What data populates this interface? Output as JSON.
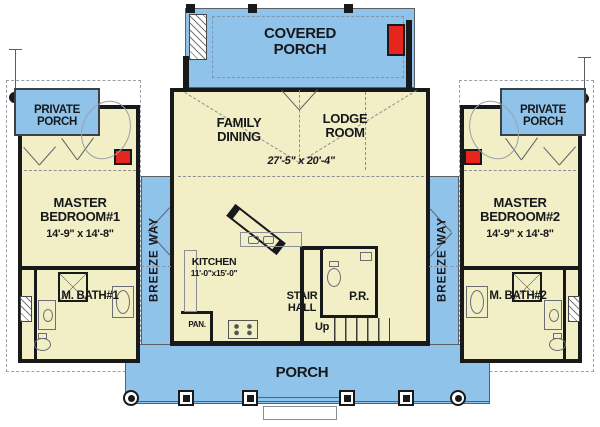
{
  "colors": {
    "porch_blue": "#8fc3ea",
    "room_cream": "#f2eec5",
    "wall_black": "#17191b",
    "fireplace_red": "#e6251c"
  },
  "rooms": {
    "covered_porch": {
      "label": "COVERED PORCH"
    },
    "great_room": {
      "dining_label": "FAMILY DINING",
      "lodge_label": "LODGE ROOM",
      "dims": "27'-5\" x 20'-4\""
    },
    "kitchen": {
      "label": "KITCHEN",
      "dims": "11'-0\"x15'-0\"",
      "pantry_label": "PAN."
    },
    "stair_hall": {
      "label": "STAIR HALL",
      "up_label": "Up",
      "powder_label": "P.R."
    },
    "porch": {
      "label": "PORCH"
    },
    "breezeways": {
      "left": "BREEZE WAY",
      "right": "BREEZE WAY"
    },
    "private_porches": {
      "left": "PRIVATE PORCH",
      "right": "PRIVATE PORCH"
    },
    "master_bedroom_1": {
      "label": "MASTER BEDROOM#1",
      "dims": "14'-9\" x 14'-8\""
    },
    "master_bedroom_2": {
      "label": "MASTER BEDROOM#2",
      "dims": "14'-9\" x 14'-8\""
    },
    "master_bath_1": {
      "label": "M. BATH#1"
    },
    "master_bath_2": {
      "label": "M. BATH#2"
    }
  }
}
